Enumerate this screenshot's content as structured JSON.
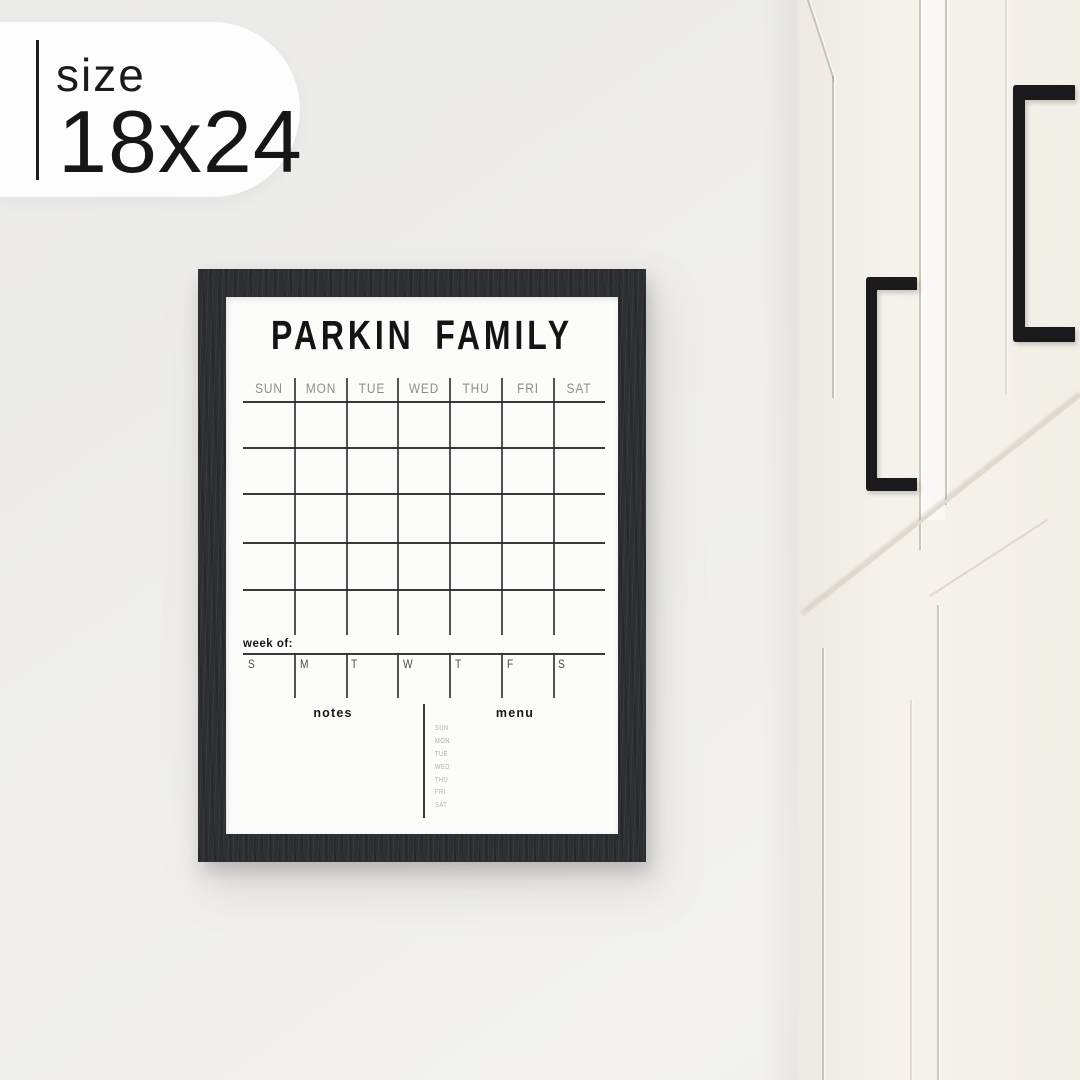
{
  "size_badge": {
    "label": "size",
    "value": "18x24"
  },
  "calendar": {
    "title": "PARKIN FAMILY",
    "day_headers": [
      "SUN",
      "MON",
      "TUE",
      "WED",
      "THU",
      "FRI",
      "SAT"
    ],
    "month_grid": {
      "columns": 7,
      "rows": 5
    },
    "week_of_label": "week of:",
    "week_day_letters": [
      "S",
      "M",
      "T",
      "W",
      "T",
      "F",
      "S"
    ],
    "notes_label": "notes",
    "menu_label": "menu",
    "menu_day_labels": [
      "SUN",
      "MON",
      "TUE",
      "WED",
      "THU",
      "FRI",
      "SAT"
    ]
  },
  "colors": {
    "wall": "#efeeec",
    "badge_bg": "#fdfdfd",
    "badge_text": "#1b1b1b",
    "frame_wood": "#2d2f32",
    "board_bg": "#fcfcfb",
    "grid_line": "#3a3a3c",
    "title_text": "#141414",
    "day_header_text": "#8e8e8e",
    "week_letter_text": "#4c4c4c",
    "menu_day_text": "#b1aea7",
    "cabinet_face": "#f4f1ea",
    "handle_black": "#1a1a1c"
  }
}
